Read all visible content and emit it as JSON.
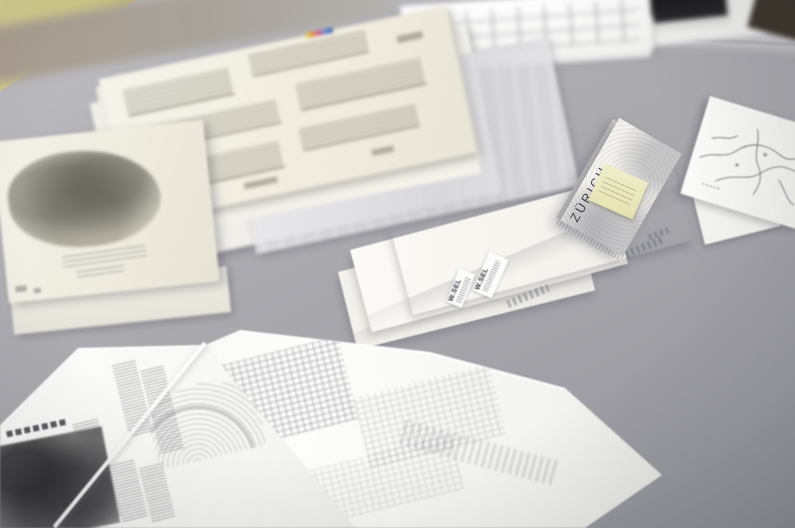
{
  "scene": {
    "type": "photograph",
    "description": "Architectural drawings on tracing paper, white envelopes with small typed labels, a folded ZÜRICH city map with a yellow sticky note, and a large folded printed plan document laid out on a grey table",
    "map_booklet": {
      "title": "ZÜRICH",
      "has_sticky_note": true
    },
    "envelopes": [
      {
        "label": "W.SEL"
      },
      {
        "label": "W.SEL"
      },
      {
        "label": "W.SEL"
      }
    ],
    "objects": [
      {
        "name": "top-paper-stack",
        "description": "out-of-focus stack of white documents at the table edge"
      },
      {
        "name": "black-notebook",
        "description": "black book lying on papers at the top edge"
      },
      {
        "name": "elevation-drawing-stack",
        "description": "pile of tracing-paper sheets with building elevation drawings and a colour calibration strip"
      },
      {
        "name": "glassine-sheet",
        "description": "translucent protective sheet under the drawing pile"
      },
      {
        "name": "pencil-sketch-stack",
        "description": "tracing-paper stack with a pencil perspective sketch and handwritten notes"
      },
      {
        "name": "zurich-map-booklet",
        "description": "folded city map titled ZÜRICH with a yellow sticky note"
      },
      {
        "name": "labelled-envelopes",
        "description": "white envelopes with small typed W.SEL labels and handwritten notes"
      },
      {
        "name": "sketch-map-sheet",
        "description": "hand-drawn map sketch entering from the right edge"
      },
      {
        "name": "folded-plan-document",
        "description": "large folded printed sheet with text columns, an aerial halftone photo and site plans"
      }
    ],
    "colors": {
      "table": "#a9a9ae",
      "table_far": "#c7c7ca",
      "wall": "#cfc88a",
      "paper": "#f6f5f0",
      "tracing_paper": "#efece0",
      "sticky_note": "#ece9c0",
      "print_ink": "#4a4a52",
      "notebook": "#1b1b1e"
    }
  }
}
